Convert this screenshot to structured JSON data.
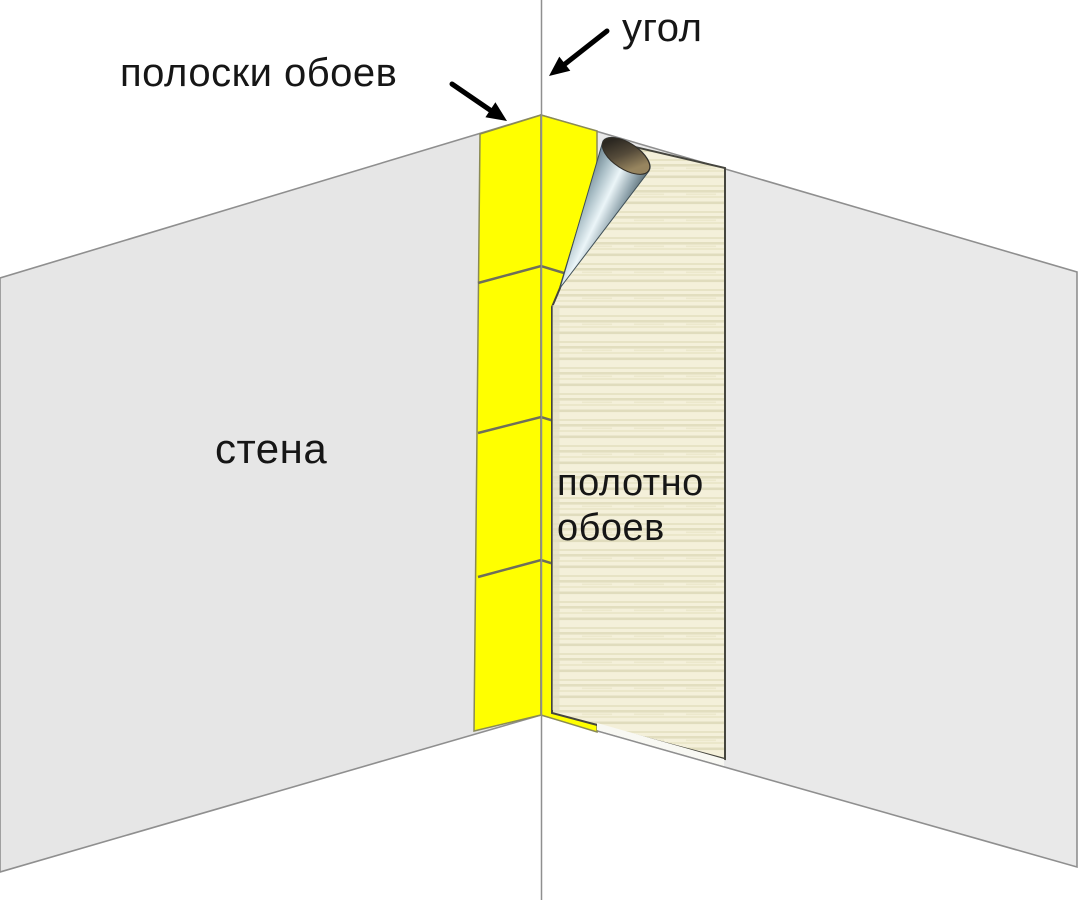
{
  "diagram": {
    "type": "instructional-illustration",
    "topic": "wallpapering an inside wall corner",
    "labels": {
      "strips_label": "полоски обоев",
      "corner_label": "угол",
      "wall_label": "стена",
      "panel_label": "полотно\nобоев"
    },
    "colors": {
      "background": "#ffffff",
      "wall_left": "#e6e6e6",
      "wall_right": "#e9e9e9",
      "strip_yellow": "#ffff00",
      "panel_base": "#f4f0da",
      "panel_stripe": "#e2debf",
      "panel_outline": "#45453e",
      "wall_outline": "#8f8f8f",
      "seam_line": "#6f6f5a",
      "curl_highlight": "#ebf5f8",
      "curl_shadow": "#47595f",
      "curl_opening_dark": "#2c2821",
      "curl_opening_rim": "#97855f",
      "arrow": "#000000"
    }
  }
}
